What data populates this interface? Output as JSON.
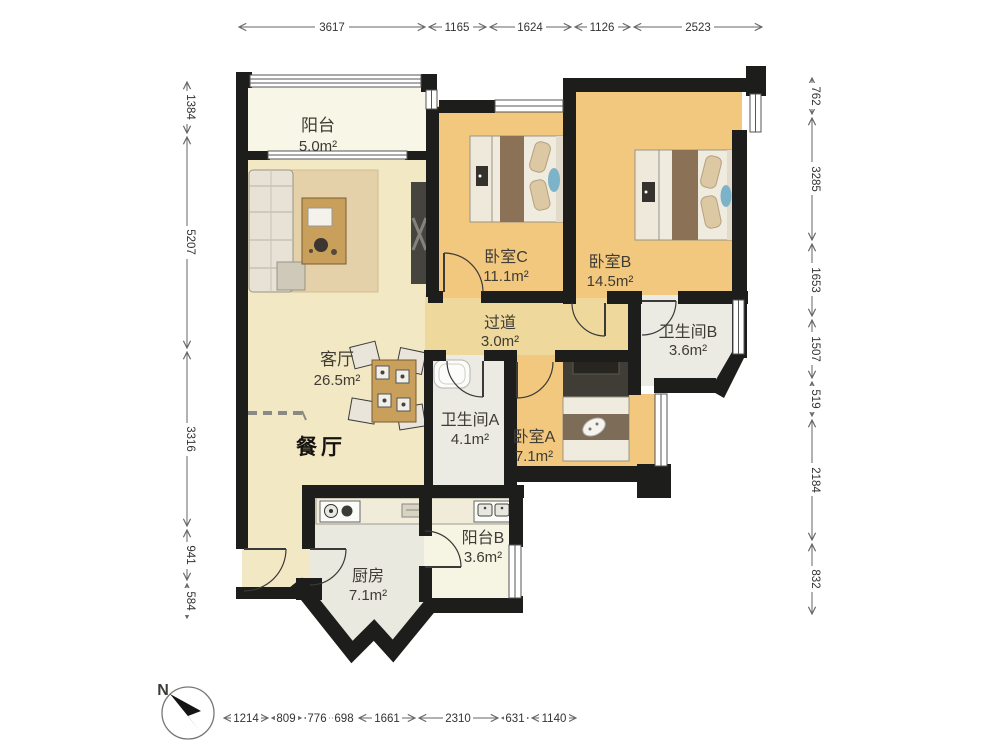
{
  "compass": {
    "label": "N"
  },
  "rooms": {
    "balcony": {
      "name": "阳台",
      "area": "5.0m²"
    },
    "living": {
      "name": "客厅",
      "area": "26.5m²"
    },
    "dining": {
      "name": "餐厅"
    },
    "bedroom_c": {
      "name": "卧室C",
      "area": "11.1m²"
    },
    "bedroom_b": {
      "name": "卧室B",
      "area": "14.5m²"
    },
    "hallway": {
      "name": "过道",
      "area": "3.0m²"
    },
    "bathroom_b": {
      "name": "卫生间B",
      "area": "3.6m²"
    },
    "bathroom_a": {
      "name": "卫生间A",
      "area": "4.1m²"
    },
    "bedroom_a": {
      "name": "卧室A",
      "area": "7.1m²"
    },
    "kitchen": {
      "name": "厨房",
      "area": "7.1m²"
    },
    "balcony_b": {
      "name": "阳台B",
      "area": "3.6m²"
    }
  },
  "dimensions": {
    "top": [
      "3617",
      "1165",
      "1624",
      "1126",
      "2523"
    ],
    "left": [
      "1384",
      "5207",
      "3316",
      "941",
      "584"
    ],
    "right": [
      "762",
      "3285",
      "1653",
      "1507",
      "519",
      "2184",
      "832"
    ],
    "bottom": [
      "1214",
      "809",
      "776",
      "698",
      "1661",
      "2310",
      "631",
      "1140"
    ]
  },
  "colors": {
    "wall": "#1d1d1b",
    "wood_floor": "#f2c87e",
    "living_floor": "#f2e8c3",
    "hall_floor": "#eed89c",
    "tile_floor": "#ebebe3",
    "balcony_floor": "#f8f6e7"
  }
}
